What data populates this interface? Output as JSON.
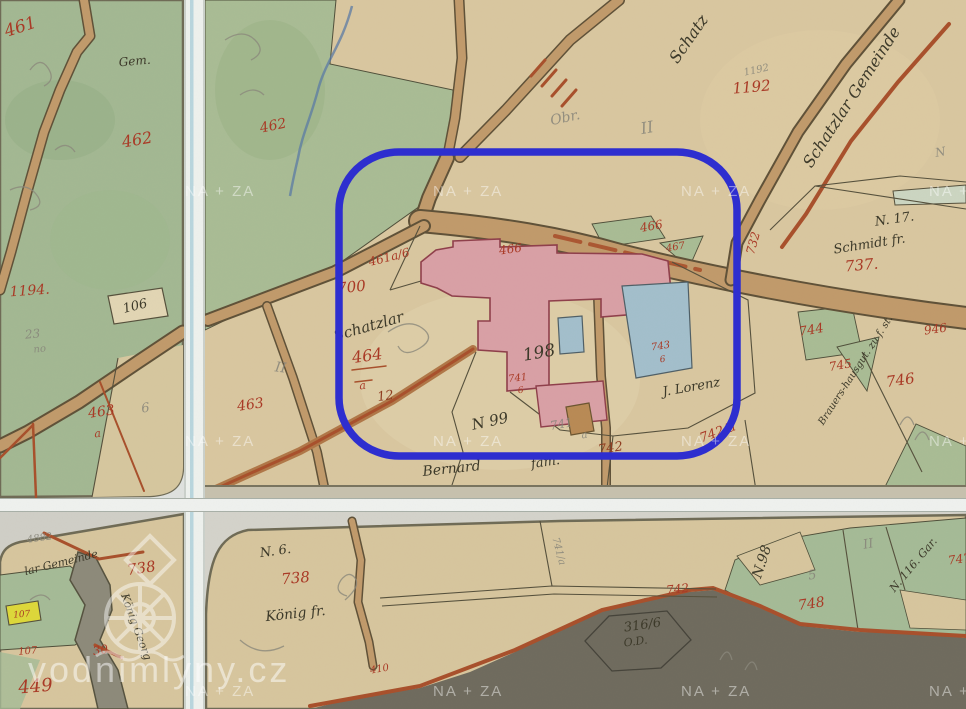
{
  "annotation": {
    "color": "#2e2ecf",
    "shape": "rounded-rectangle-highlight"
  },
  "watermark": {
    "tile_text": "NA + ZA",
    "brand_text": "vodnimlyny.cz",
    "tiles": [
      {
        "x": 211,
        "y": 191
      },
      {
        "x": 459,
        "y": 191
      },
      {
        "x": 707,
        "y": 191
      },
      {
        "x": 955,
        "y": 191
      },
      {
        "x": 211,
        "y": 441
      },
      {
        "x": 459,
        "y": 441
      },
      {
        "x": 707,
        "y": 441
      },
      {
        "x": 955,
        "y": 441
      },
      {
        "x": 211,
        "y": 691
      },
      {
        "x": 459,
        "y": 691
      },
      {
        "x": 707,
        "y": 691
      },
      {
        "x": 955,
        "y": 691
      }
    ]
  },
  "labels": [
    {
      "t": "461",
      "x": 22,
      "y": 32,
      "r": -18,
      "c": "red",
      "s": 17
    },
    {
      "t": "Gem.",
      "x": 135,
      "y": 65,
      "r": -5,
      "c": "ink",
      "s": 12
    },
    {
      "t": "462",
      "x": 138,
      "y": 145,
      "r": -10,
      "c": "red",
      "s": 16
    },
    {
      "t": "1194.",
      "x": 30,
      "y": 295,
      "r": -4,
      "c": "red",
      "s": 14
    },
    {
      "t": "106",
      "x": 136,
      "y": 310,
      "r": -14,
      "c": "ink",
      "s": 13
    },
    {
      "t": "23",
      "x": 33,
      "y": 338,
      "r": -6,
      "c": "pencil",
      "s": 12
    },
    {
      "t": "no",
      "x": 40,
      "y": 352,
      "r": -6,
      "c": "pencil",
      "s": 10
    },
    {
      "t": "463",
      "x": 102,
      "y": 416,
      "r": -8,
      "c": "red",
      "s": 14
    },
    {
      "t": "a",
      "x": 98,
      "y": 437,
      "r": -8,
      "c": "red",
      "s": 11
    },
    {
      "t": "6",
      "x": 146,
      "y": 412,
      "r": -8,
      "c": "pencil",
      "s": 13
    },
    {
      "t": "462",
      "x": 274,
      "y": 130,
      "r": -12,
      "c": "red",
      "s": 14
    },
    {
      "t": "Schatz",
      "x": 693,
      "y": 42,
      "r": -55,
      "c": "ink",
      "s": 16
    },
    {
      "t": "1192",
      "x": 752,
      "y": 92,
      "r": -5,
      "c": "red",
      "s": 15
    },
    {
      "t": "1192",
      "x": 757,
      "y": 73,
      "r": -12,
      "c": "pencil",
      "s": 10
    },
    {
      "t": "Schatzlar Gemeinde",
      "x": 856,
      "y": 100,
      "r": -57,
      "c": "ink",
      "s": 16
    },
    {
      "t": "Obr.",
      "x": 566,
      "y": 122,
      "r": -12,
      "c": "pencil",
      "s": 14
    },
    {
      "t": "II",
      "x": 648,
      "y": 133,
      "r": -10,
      "c": "pencil",
      "s": 16
    },
    {
      "t": "N. 17.",
      "x": 895,
      "y": 223,
      "r": -8,
      "c": "ink",
      "s": 13
    },
    {
      "t": "Schmidt fr.",
      "x": 870,
      "y": 248,
      "r": -9,
      "c": "ink",
      "s": 13
    },
    {
      "t": "737.",
      "x": 862,
      "y": 270,
      "r": -5,
      "c": "red",
      "s": 15
    },
    {
      "t": "732",
      "x": 757,
      "y": 244,
      "r": -75,
      "c": "red",
      "s": 12
    },
    {
      "t": "466",
      "x": 511,
      "y": 253,
      "r": -8,
      "c": "red",
      "s": 12
    },
    {
      "t": "466",
      "x": 652,
      "y": 230,
      "r": -10,
      "c": "red",
      "s": 12
    },
    {
      "t": "467",
      "x": 676,
      "y": 250,
      "r": -10,
      "c": "red",
      "s": 10
    },
    {
      "t": "461a/6",
      "x": 390,
      "y": 261,
      "r": -14,
      "c": "red",
      "s": 12
    },
    {
      "t": "700",
      "x": 352,
      "y": 292,
      "r": -6,
      "c": "red",
      "s": 15
    },
    {
      "t": "Schatzlar",
      "x": 370,
      "y": 331,
      "r": -16,
      "c": "ink",
      "s": 15
    },
    {
      "t": "464",
      "x": 368,
      "y": 361,
      "r": -8,
      "c": "red",
      "s": 16
    },
    {
      "t": "a",
      "x": 363,
      "y": 389,
      "r": -8,
      "c": "red",
      "s": 11
    },
    {
      "t": "12",
      "x": 386,
      "y": 400,
      "r": -8,
      "c": "rb",
      "s": 13
    },
    {
      "t": "463",
      "x": 251,
      "y": 409,
      "r": -8,
      "c": "red",
      "s": 14
    },
    {
      "t": "II",
      "x": 280,
      "y": 372,
      "r": 8,
      "c": "pencil",
      "s": 14
    },
    {
      "t": "198",
      "x": 540,
      "y": 358,
      "r": -10,
      "c": "ink",
      "s": 17
    },
    {
      "t": "741",
      "x": 518,
      "y": 381,
      "r": -6,
      "c": "red",
      "s": 10
    },
    {
      "t": "6",
      "x": 521,
      "y": 393,
      "r": -6,
      "c": "red",
      "s": 9
    },
    {
      "t": "743",
      "x": 661,
      "y": 349,
      "r": -8,
      "c": "red",
      "s": 10
    },
    {
      "t": "6",
      "x": 663,
      "y": 362,
      "r": -8,
      "c": "red",
      "s": 9
    },
    {
      "t": "N 99",
      "x": 491,
      "y": 426,
      "r": -12,
      "c": "ink",
      "s": 15
    },
    {
      "t": "741",
      "x": 562,
      "y": 428,
      "r": -10,
      "c": "pencil",
      "s": 12
    },
    {
      "t": "a",
      "x": 585,
      "y": 438,
      "r": -10,
      "c": "pencil",
      "s": 10
    },
    {
      "t": "Bernard",
      "x": 452,
      "y": 473,
      "r": -6,
      "c": "ink",
      "s": 14
    },
    {
      "t": "fam.",
      "x": 546,
      "y": 466,
      "r": -8,
      "c": "ink",
      "s": 13
    },
    {
      "t": "742",
      "x": 611,
      "y": 452,
      "r": -8,
      "c": "rb",
      "s": 13
    },
    {
      "t": "742/a",
      "x": 719,
      "y": 436,
      "r": -20,
      "c": "red",
      "s": 13
    },
    {
      "t": "J. Lorenz",
      "x": 692,
      "y": 391,
      "r": -10,
      "c": "ink",
      "s": 13
    },
    {
      "t": "Brauers-hausgut. zu f. st.",
      "x": 858,
      "y": 372,
      "r": -57,
      "c": "ink",
      "s": 10
    },
    {
      "t": "744",
      "x": 812,
      "y": 334,
      "r": -10,
      "c": "red",
      "s": 13
    },
    {
      "t": "745",
      "x": 841,
      "y": 369,
      "r": -10,
      "c": "red",
      "s": 12
    },
    {
      "t": "746",
      "x": 901,
      "y": 385,
      "r": -8,
      "c": "red",
      "s": 15
    },
    {
      "t": "946",
      "x": 936,
      "y": 333,
      "r": -8,
      "c": "red",
      "s": 12
    },
    {
      "t": "N",
      "x": 941,
      "y": 156,
      "r": -10,
      "c": "pencil",
      "s": 12
    },
    {
      "t": "4882",
      "x": 40,
      "y": 541,
      "r": -8,
      "c": "pencil",
      "s": 10
    },
    {
      "t": "lar Gemeinde",
      "x": 62,
      "y": 566,
      "r": -14,
      "c": "ink",
      "s": 11
    },
    {
      "t": "738",
      "x": 142,
      "y": 573,
      "r": -8,
      "c": "red",
      "s": 15
    },
    {
      "t": "König Georg",
      "x": 133,
      "y": 628,
      "r": 70,
      "c": "ink",
      "s": 11
    },
    {
      "t": "107",
      "x": 22,
      "y": 617,
      "r": -5,
      "c": "red",
      "s": 9
    },
    {
      "t": "107",
      "x": 28,
      "y": 654,
      "r": -5,
      "c": "red",
      "s": 10
    },
    {
      "t": "30",
      "x": 101,
      "y": 654,
      "r": -8,
      "c": "red",
      "s": 12
    },
    {
      "t": "449",
      "x": 36,
      "y": 692,
      "r": -5,
      "c": "red",
      "s": 18
    },
    {
      "t": "N. 6.",
      "x": 276,
      "y": 555,
      "r": -8,
      "c": "ink",
      "s": 13
    },
    {
      "t": "738",
      "x": 296,
      "y": 583,
      "r": -5,
      "c": "red",
      "s": 15
    },
    {
      "t": "König fr.",
      "x": 296,
      "y": 618,
      "r": -6,
      "c": "ink",
      "s": 14
    },
    {
      "t": "410",
      "x": 380,
      "y": 672,
      "r": -10,
      "c": "red",
      "s": 10
    },
    {
      "t": "741/a",
      "x": 556,
      "y": 552,
      "r": 75,
      "c": "pencil",
      "s": 10
    },
    {
      "t": "742",
      "x": 678,
      "y": 593,
      "r": -6,
      "c": "red",
      "s": 12
    },
    {
      "t": "N.98",
      "x": 766,
      "y": 563,
      "r": -72,
      "c": "ink",
      "s": 14
    },
    {
      "t": "316/6",
      "x": 643,
      "y": 629,
      "r": -8,
      "c": "ink",
      "s": 13
    },
    {
      "t": "O.D.",
      "x": 636,
      "y": 645,
      "r": -8,
      "c": "ink",
      "s": 11
    },
    {
      "t": "748",
      "x": 812,
      "y": 608,
      "r": -8,
      "c": "red",
      "s": 14
    },
    {
      "t": "5",
      "x": 813,
      "y": 579,
      "r": -10,
      "c": "pencil",
      "s": 13
    },
    {
      "t": "N. 116. Gar.",
      "x": 916,
      "y": 567,
      "r": -50,
      "c": "ink",
      "s": 11
    },
    {
      "t": "747",
      "x": 960,
      "y": 563,
      "r": -8,
      "c": "red",
      "s": 12
    },
    {
      "t": "II",
      "x": 869,
      "y": 548,
      "r": -10,
      "c": "pencil",
      "s": 13
    }
  ]
}
